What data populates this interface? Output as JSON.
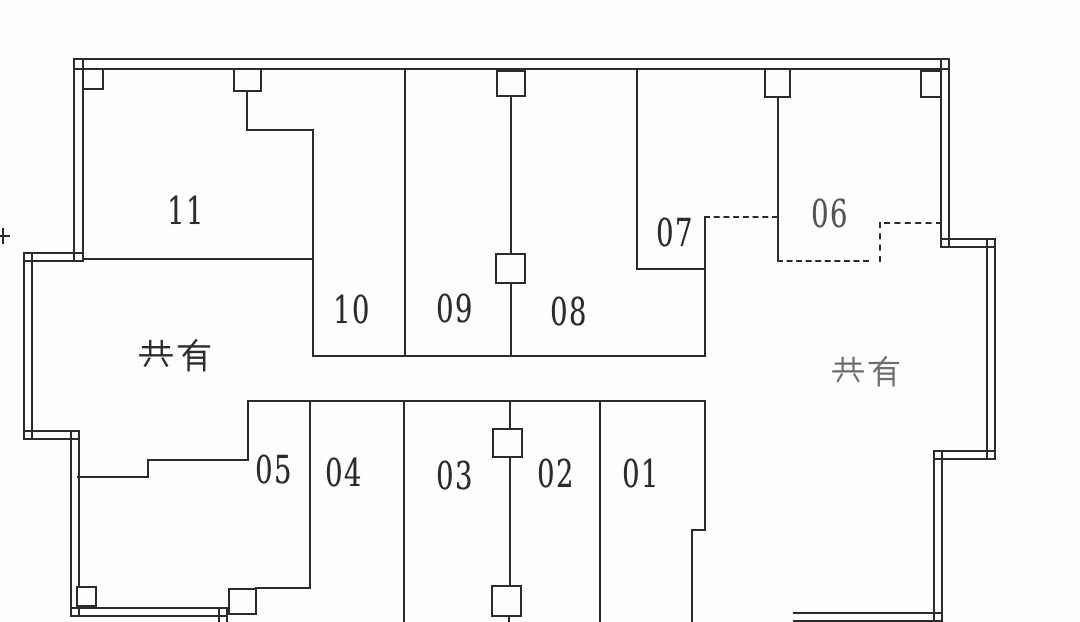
{
  "colors": {
    "paper": "#fdfdfc",
    "ink": "#2b2b2b"
  },
  "plan": {
    "units": [
      {
        "number": "11"
      },
      {
        "number": "10"
      },
      {
        "number": "09"
      },
      {
        "number": "08"
      },
      {
        "number": "07"
      },
      {
        "number": "06"
      },
      {
        "number": "05"
      },
      {
        "number": "04"
      },
      {
        "number": "03"
      },
      {
        "number": "02"
      },
      {
        "number": "01"
      }
    ],
    "common_areas": [
      {
        "label": "共有",
        "side": "west"
      },
      {
        "label": "共有",
        "side": "east"
      }
    ]
  }
}
